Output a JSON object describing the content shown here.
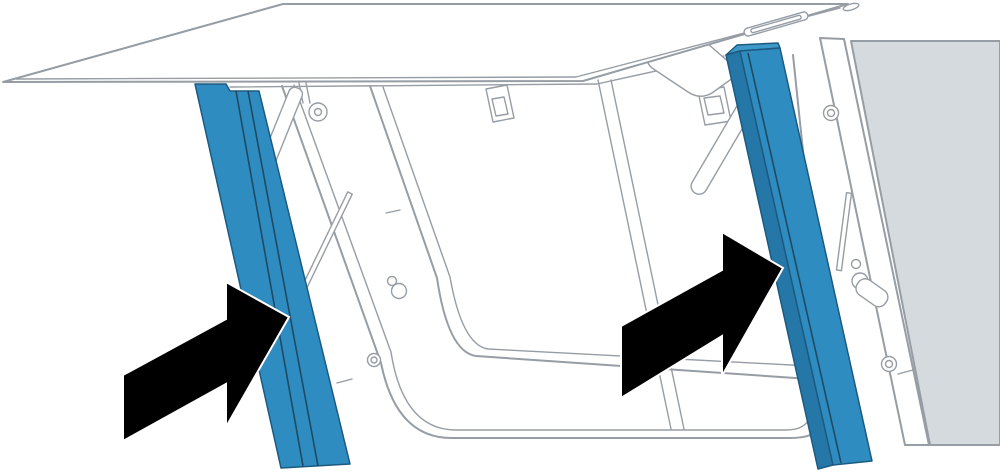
{
  "figure": {
    "type": "technical-illustration",
    "subject": "open top-hinged hatch window with two highlighted side seal rails",
    "colors": {
      "background": "#ffffff",
      "line": "#969da4",
      "wall_fill": "#d5dade",
      "rail_blue": "#2e8cc0",
      "rail_blue_dark": "#2577a8",
      "rail_blue_top": "#3e99c8",
      "rail_outline": "#1c5a80",
      "rail_groove": "#1e4a63",
      "arrow_black": "#000000",
      "arrow_halo": "#ffffff"
    },
    "highlights": [
      {
        "name": "left-seal-rail",
        "color_key": "rail_blue"
      },
      {
        "name": "right-seal-rail",
        "color_key": "rail_blue"
      }
    ],
    "annotations": [
      {
        "name": "left-arrow",
        "points_to": "left-seal-rail"
      },
      {
        "name": "right-arrow",
        "points_to": "right-seal-rail"
      }
    ]
  }
}
